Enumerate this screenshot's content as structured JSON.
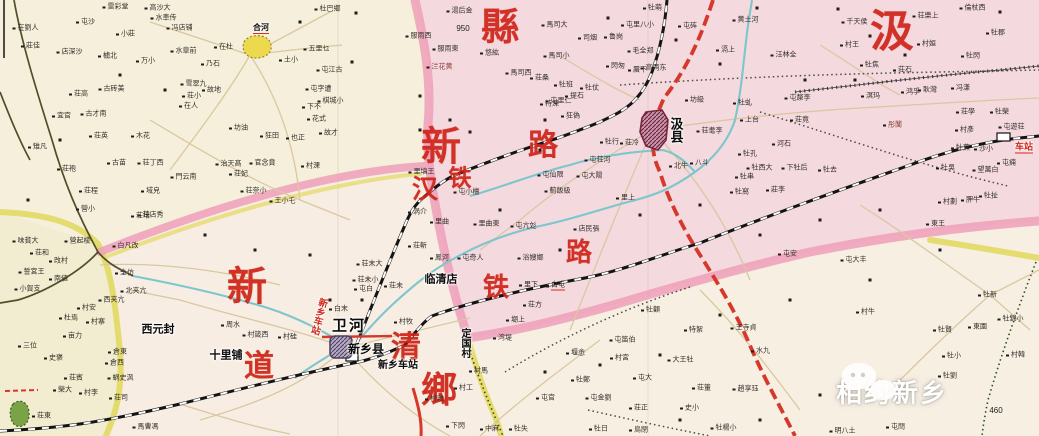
{
  "map": {
    "title": "历史地图：新乡县·汲县（平汉铁路/道清铁路）",
    "watermark": {
      "text": "相约新乡"
    },
    "palette": {
      "big_label_red": "#ce2418",
      "boundary_pink": "#ee9fba",
      "boundary_yellow": "#e3da62",
      "road_red": "#d5392b",
      "river_teal": "#7cc6cc",
      "river_dark": "#4f4f2a",
      "region_pink": "#f2d3de",
      "region_cream": "#f7efe2",
      "city_purple": "#7d6f96",
      "city_maroon": "#8e3752"
    },
    "big_red_labels": [
      {
        "t": "縣",
        "x": 500,
        "y": 28,
        "s": 38
      },
      {
        "t": "汲",
        "x": 892,
        "y": 32,
        "s": 44
      },
      {
        "t": "新",
        "x": 441,
        "y": 147,
        "s": 40
      },
      {
        "t": "路",
        "x": 543,
        "y": 146,
        "s": 30
      },
      {
        "t": "铁",
        "x": 460,
        "y": 178,
        "s": 23
      },
      {
        "t": "汉",
        "x": 425,
        "y": 190,
        "s": 26
      },
      {
        "t": "路",
        "x": 579,
        "y": 253,
        "s": 26
      },
      {
        "t": "铁",
        "x": 496,
        "y": 288,
        "s": 26
      },
      {
        "t": "新",
        "x": 247,
        "y": 287,
        "s": 40
      },
      {
        "t": "清",
        "x": 406,
        "y": 348,
        "s": 30
      },
      {
        "t": "道",
        "x": 259,
        "y": 367,
        "s": 30
      },
      {
        "t": "鄉",
        "x": 439,
        "y": 390,
        "s": 36
      }
    ],
    "place_labels": [
      {
        "t": "西元封",
        "x": 158,
        "y": 330,
        "s": 11
      },
      {
        "t": "十里铺",
        "x": 226,
        "y": 356,
        "s": 11
      },
      {
        "t": "卫河",
        "x": 349,
        "y": 326,
        "s": 15,
        "ls": 2
      },
      {
        "t": "新乡县",
        "x": 366,
        "y": 349,
        "s": 12
      },
      {
        "t": "新乡车站",
        "x": 398,
        "y": 366,
        "s": 10
      },
      {
        "t": "临清店",
        "x": 441,
        "y": 280,
        "s": 11
      },
      {
        "t": "定国村",
        "x": 464,
        "y": 343,
        "s": 10,
        "vert": 1
      },
      {
        "t": "汲县",
        "x": 676,
        "y": 130,
        "s": 13,
        "vert": 1
      },
      {
        "t": "新乡车站",
        "x": 318,
        "y": 316,
        "s": 9.5,
        "vert": 1,
        "rot": 15,
        "c": "#cf2a1b"
      },
      {
        "t": "车站",
        "x": 1024,
        "y": 148,
        "s": 9,
        "c": "#cf2a1b",
        "u": 1
      },
      {
        "t": "合河",
        "x": 261,
        "y": 29,
        "s": 8,
        "u": 1
      }
    ],
    "spot_heights": [
      {
        "t": "950",
        "x": 463,
        "y": 29,
        "s": 8
      },
      {
        "t": "460",
        "x": 996,
        "y": 411,
        "s": 8
      }
    ],
    "village_labels": [
      [
        "雷彩堂",
        118,
        7
      ],
      [
        "高沙大",
        160,
        8
      ],
      [
        "水車传",
        166,
        18
      ],
      [
        "冯店铺",
        182,
        28
      ],
      [
        "杜巴鄉",
        330,
        9
      ],
      [
        "在劉人",
        28,
        28
      ],
      [
        "屯沙",
        88,
        22
      ],
      [
        "小莊",
        128,
        34
      ],
      [
        "莊佳",
        33,
        46
      ],
      [
        "店深沙",
        72,
        52
      ],
      [
        "㯭北",
        110,
        56
      ],
      [
        "万小",
        148,
        61
      ],
      [
        "水章前",
        186,
        51
      ],
      [
        "在杜",
        226,
        47
      ],
      [
        "乃石",
        213,
        64
      ],
      [
        "五里乜",
        319,
        49
      ],
      [
        "土小",
        291,
        60
      ],
      [
        "屯江古",
        332,
        70
      ],
      [
        "屯字遭",
        321,
        89
      ],
      [
        "棋城小",
        333,
        101
      ],
      [
        "下不",
        314,
        107
      ],
      [
        "花式",
        319,
        119
      ],
      [
        "荘高",
        81,
        94
      ],
      [
        "古砖美",
        114,
        89
      ],
      [
        "雪翠九",
        196,
        84
      ],
      [
        "荘小",
        194,
        96
      ],
      [
        "在人",
        191,
        106
      ],
      [
        "故地",
        214,
        90
      ],
      [
        "宜官",
        64,
        116
      ],
      [
        "古才南",
        96,
        114
      ],
      [
        "荘英",
        101,
        136
      ],
      [
        "木花",
        143,
        136
      ],
      [
        "荘袍",
        69,
        169
      ],
      [
        "古苗",
        119,
        163
      ],
      [
        "荘丁西",
        153,
        163
      ],
      [
        "門云南",
        186,
        177
      ],
      [
        "域皃",
        153,
        191
      ],
      [
        "荘程",
        91,
        191
      ],
      [
        "營小",
        88,
        209
      ],
      [
        "荘店秀",
        153,
        215
      ],
      [
        "坊油",
        241,
        128
      ],
      [
        "狂田",
        272,
        136
      ],
      [
        "也正",
        298,
        138
      ],
      [
        "故才",
        331,
        133
      ],
      [
        "官念賁",
        265,
        163
      ],
      [
        "治天髙",
        231,
        164
      ],
      [
        "荘妃",
        241,
        174
      ],
      [
        "村淉",
        313,
        166
      ],
      [
        "荘奈小",
        256,
        191
      ],
      [
        "王小乇",
        285,
        201
      ],
      [
        "雉凡",
        40,
        147
      ],
      [
        "味貧大",
        28,
        241
      ],
      [
        "營起棱",
        80,
        241
      ],
      [
        "白凡改",
        128,
        246
      ],
      [
        "荘和",
        42,
        253
      ],
      [
        "攺村",
        61,
        261
      ],
      [
        "誓宮王",
        34,
        272
      ],
      [
        "南値",
        61,
        279
      ],
      [
        "全仿",
        127,
        273
      ],
      [
        "小賀支",
        30,
        289
      ],
      [
        "西夹亢",
        114,
        300
      ],
      [
        "北夹亢",
        136,
        291
      ],
      [
        "村安",
        89,
        308
      ],
      [
        "杜焉",
        71,
        318
      ],
      [
        "村寨",
        98,
        322
      ],
      [
        "亩力",
        75,
        336
      ],
      [
        "三位",
        30,
        346
      ],
      [
        "史褒",
        56,
        358
      ],
      [
        "倉東",
        120,
        352
      ],
      [
        "倉西",
        117,
        363
      ],
      [
        "蜗史沨",
        123,
        378
      ],
      [
        "荘賓",
        76,
        378
      ],
      [
        "榮大",
        65,
        390
      ],
      [
        "村李",
        91,
        393
      ],
      [
        "荘司",
        121,
        398
      ],
      [
        "馬曹馮",
        148,
        427
      ],
      [
        "荘東",
        44,
        416
      ],
      [
        "荘培",
        143,
        216
      ],
      [
        "周水",
        233,
        325
      ],
      [
        "村箴西",
        258,
        335
      ],
      [
        "村硅",
        290,
        337
      ],
      [
        "荘末大",
        372,
        264
      ],
      [
        "荘未小",
        368,
        280
      ],
      [
        "屯白",
        366,
        289
      ],
      [
        "荘未",
        396,
        286
      ],
      [
        "白末",
        341,
        309
      ],
      [
        "村牧",
        406,
        322
      ],
      [
        "涡介",
        420,
        212
      ],
      [
        "屯小檀",
        469,
        192
      ],
      [
        "里曲",
        442,
        222
      ],
      [
        "里曲東",
        489,
        224
      ],
      [
        "屯亢彣",
        526,
        226
      ],
      [
        "店民張",
        589,
        229
      ],
      [
        "荘斬",
        420,
        246
      ],
      [
        "鳯河",
        442,
        258
      ],
      [
        "屯奇人",
        473,
        258
      ],
      [
        "浴嫂嫏",
        533,
        258
      ],
      [
        "薊飯級",
        560,
        191
      ],
      [
        "屯仙限",
        553,
        175
      ],
      [
        "屯大陽",
        592,
        176
      ],
      [
        "屯荘河",
        600,
        160
      ],
      [
        "里上",
        628,
        198
      ],
      [
        "北牛",
        681,
        166
      ],
      [
        "八斗",
        702,
        163
      ],
      [
        "牡行",
        612,
        142
      ],
      [
        "荘冷",
        632,
        143
      ],
      [
        "屯里仁",
        561,
        101
      ],
      [
        "牡班",
        566,
        85
      ],
      [
        "牡仗",
        592,
        88
      ],
      [
        "提石",
        577,
        96
      ],
      [
        "特淉",
        552,
        104
      ],
      [
        "狂偽",
        573,
        116
      ],
      [
        "馬司西",
        521,
        73
      ],
      [
        "馬司小",
        559,
        56
      ],
      [
        "馬司大",
        557,
        25
      ],
      [
        "荘桑",
        542,
        78
      ],
      [
        "湯后金",
        462,
        11
      ],
      [
        "服雨西",
        421,
        36
      ],
      [
        "服雨東",
        448,
        49
      ],
      [
        "㳕花黄",
        442,
        67,
        "c"
      ],
      [
        "悠紘",
        492,
        53
      ],
      [
        "司烟",
        590,
        38
      ],
      [
        "里填王",
        424,
        172
      ],
      [
        "鲁岗",
        616,
        37
      ],
      [
        "毛全郑",
        643,
        51
      ],
      [
        "屯里八小",
        640,
        25
      ],
      [
        "屯砗",
        690,
        26
      ],
      [
        "牡萌",
        655,
        8
      ],
      [
        "黄土河",
        748,
        20
      ],
      [
        "滆上",
        728,
        50
      ],
      [
        "汪林全",
        786,
        55
      ],
      [
        "閃匆",
        618,
        66
      ],
      [
        "蜃下",
        640,
        70
      ],
      [
        "高两东",
        656,
        68
      ],
      [
        "坊級",
        697,
        100
      ],
      [
        "上台",
        752,
        120
      ],
      [
        "荘耄李",
        712,
        131
      ],
      [
        "牡虬",
        745,
        103
      ],
      [
        "荘竟",
        802,
        120
      ],
      [
        "屯漦李",
        800,
        98
      ],
      [
        "河石",
        784,
        144
      ],
      [
        "牡孔",
        750,
        154
      ],
      [
        "牡西大",
        762,
        168
      ],
      [
        "牡串",
        747,
        177
      ],
      [
        "下牡后",
        797,
        168
      ],
      [
        "牡去",
        830,
        170
      ],
      [
        "莊李",
        778,
        190
      ],
      [
        "牡窩",
        742,
        192
      ],
      [
        "倫杖西",
        975,
        8
      ],
      [
        "荘樂上",
        928,
        16
      ],
      [
        "牡郡",
        998,
        33
      ],
      [
        "村姮",
        929,
        44
      ],
      [
        "牡閃",
        973,
        56
      ],
      [
        "千天侯",
        857,
        22
      ],
      [
        "村王",
        852,
        45
      ],
      [
        "牡焦",
        872,
        65
      ],
      [
        "荘石",
        905,
        70
      ],
      [
        "耿灣",
        930,
        90
      ],
      [
        "鸿孚",
        913,
        92
      ],
      [
        "冯溓",
        963,
        88
      ],
      [
        "溟玛",
        873,
        96
      ],
      [
        "荘學",
        968,
        112
      ],
      [
        "牡榮",
        1002,
        112
      ],
      [
        "村彥",
        967,
        130
      ],
      [
        "屯遊荘",
        1014,
        127
      ],
      [
        "彤闅",
        895,
        125,
        "c"
      ],
      [
        "牡蕉",
        963,
        148
      ],
      [
        "沙小",
        986,
        149
      ],
      [
        "牡吳",
        948,
        168
      ],
      [
        "望萬白",
        988,
        170
      ],
      [
        "屯痈",
        1009,
        163
      ],
      [
        "牡扯",
        991,
        196
      ],
      [
        "村劃",
        950,
        202
      ],
      [
        "胛牛",
        973,
        200
      ],
      [
        "東王",
        938,
        224
      ],
      [
        "牡新",
        990,
        295
      ],
      [
        "東園",
        980,
        327
      ],
      [
        "牡錦小",
        1013,
        319
      ],
      [
        "牡賢",
        945,
        330
      ],
      [
        "牡小",
        954,
        356
      ],
      [
        "村韓",
        1018,
        355
      ],
      [
        "牡劉",
        950,
        376
      ],
      [
        "屯閆",
        898,
        427
      ],
      [
        "明八土",
        845,
        431
      ],
      [
        "里下",
        531,
        285
      ],
      [
        "白屯",
        558,
        286,
        "u"
      ],
      [
        "荘方",
        535,
        305
      ],
      [
        "㙟上",
        518,
        320
      ],
      [
        "湾堤",
        505,
        338
      ],
      [
        "堰悆",
        578,
        353
      ],
      [
        "屯笛伯",
        625,
        340
      ],
      [
        "村宮",
        622,
        358
      ],
      [
        "牡顴",
        653,
        310
      ],
      [
        "特絮",
        696,
        330
      ],
      [
        "大王牡",
        683,
        360
      ],
      [
        "屯大",
        645,
        378
      ],
      [
        "牡鄭",
        583,
        380
      ],
      [
        "屯官",
        548,
        398
      ],
      [
        "屯金劉",
        601,
        398
      ],
      [
        "荘正",
        641,
        408
      ],
      [
        "史小",
        692,
        408
      ],
      [
        "荘箽",
        704,
        388
      ],
      [
        "趙享珏",
        748,
        389
      ],
      [
        "王寺貞",
        746,
        328
      ],
      [
        "水九",
        763,
        351
      ],
      [
        "牡楊小",
        726,
        428
      ],
      [
        "牡日",
        601,
        429
      ],
      [
        "鳥閉",
        641,
        430
      ],
      [
        "中麻",
        492,
        429
      ],
      [
        "下閃",
        458,
        426
      ],
      [
        "牡失",
        521,
        429
      ],
      [
        "村馬",
        481,
        371
      ],
      [
        "村工",
        466,
        388
      ],
      [
        "村攺",
        437,
        399
      ],
      [
        "屯安",
        790,
        254
      ],
      [
        "屯大丰",
        856,
        260
      ],
      [
        "村牛",
        868,
        312
      ]
    ],
    "dots": [
      [
        300,
        22
      ],
      [
        356,
        13
      ],
      [
        757,
        8
      ],
      [
        838,
        9
      ],
      [
        352,
        62
      ],
      [
        420,
        96
      ],
      [
        545,
        120
      ],
      [
        470,
        132
      ],
      [
        608,
        18
      ],
      [
        676,
        40
      ],
      [
        720,
        64
      ],
      [
        805,
        80
      ],
      [
        855,
        80
      ],
      [
        905,
        55
      ],
      [
        1000,
        12
      ],
      [
        870,
        36
      ],
      [
        120,
        75
      ],
      [
        165,
        90
      ],
      [
        60,
        140
      ],
      [
        28,
        200
      ],
      [
        205,
        235
      ],
      [
        255,
        250
      ],
      [
        310,
        255
      ],
      [
        362,
        300
      ],
      [
        330,
        300
      ],
      [
        540,
        150
      ],
      [
        500,
        210
      ],
      [
        560,
        250
      ],
      [
        640,
        215
      ],
      [
        700,
        205
      ],
      [
        760,
        235
      ],
      [
        820,
        220
      ],
      [
        880,
        210
      ],
      [
        940,
        250
      ],
      [
        870,
        280
      ],
      [
        790,
        300
      ],
      [
        720,
        315
      ],
      [
        660,
        355
      ],
      [
        600,
        365
      ],
      [
        545,
        372
      ],
      [
        760,
        420
      ],
      [
        820,
        395
      ],
      [
        680,
        420
      ],
      [
        420,
        130
      ],
      [
        450,
        120
      ]
    ]
  }
}
